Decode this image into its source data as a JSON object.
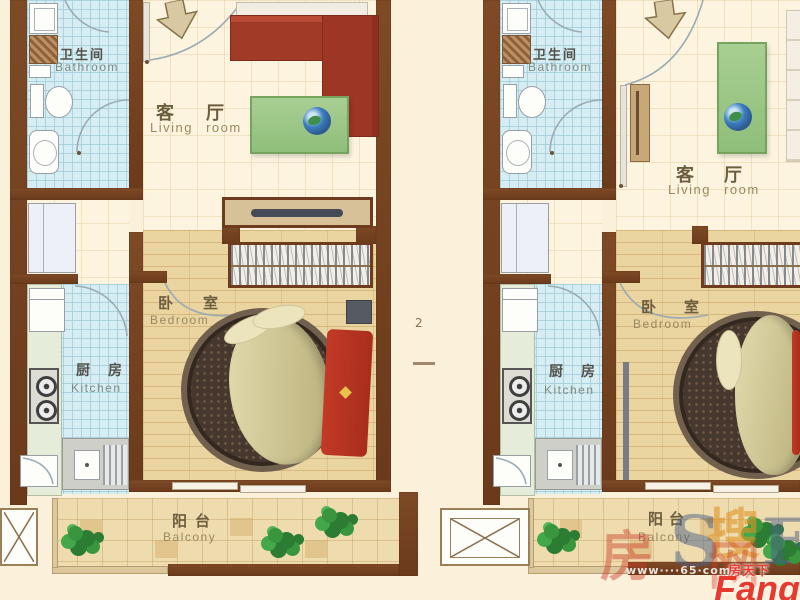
{
  "canvas": {
    "width": 800,
    "height": 600
  },
  "colors": {
    "background": "#fbf0da",
    "wall_brown": "#74401f",
    "tile_blue": "#d5edf3",
    "wood_floor": "#ead4a0",
    "balcony_tile": "#eedcae",
    "counter_green": "#e5ecd9",
    "sofa_red": "#a23a28",
    "table_green": "#9cc687",
    "brand_red": "#e8392e",
    "label_brown": "#6c5d3f"
  },
  "units": {
    "left": {
      "bathroom_zh": "卫生间",
      "bathroom_en": "Bathroom",
      "living_zh": "客厅",
      "living_en": "Living room",
      "bedroom_zh": "卧室",
      "bedroom_en": "Bedroom",
      "kitchen_zh": "厨房",
      "kitchen_en": "Kitchen",
      "balcony_zh": "阳台",
      "balcony_en": "Balcony"
    },
    "right": {
      "bathroom_zh": "卫生间",
      "bathroom_en": "Bathroom",
      "living_zh": "客厅",
      "living_en": "Living room",
      "bedroom_zh": "卧室",
      "bedroom_en": "Bedroom",
      "kitchen_zh": "厨房",
      "kitchen_en": "Kitchen",
      "balcony_zh": "阳台",
      "balcony_en": "Balcony"
    }
  },
  "watermarks": {
    "sou_char": "搜",
    "letter_s": "S",
    "letter_f": "F",
    "red_char_left": "房",
    "red_char_right": "网",
    "url_text": "www····65·com"
  },
  "logo": {
    "brand_zh": "房天下",
    "brand_en": "Fang"
  },
  "annotations": {
    "gap_number": "2"
  }
}
